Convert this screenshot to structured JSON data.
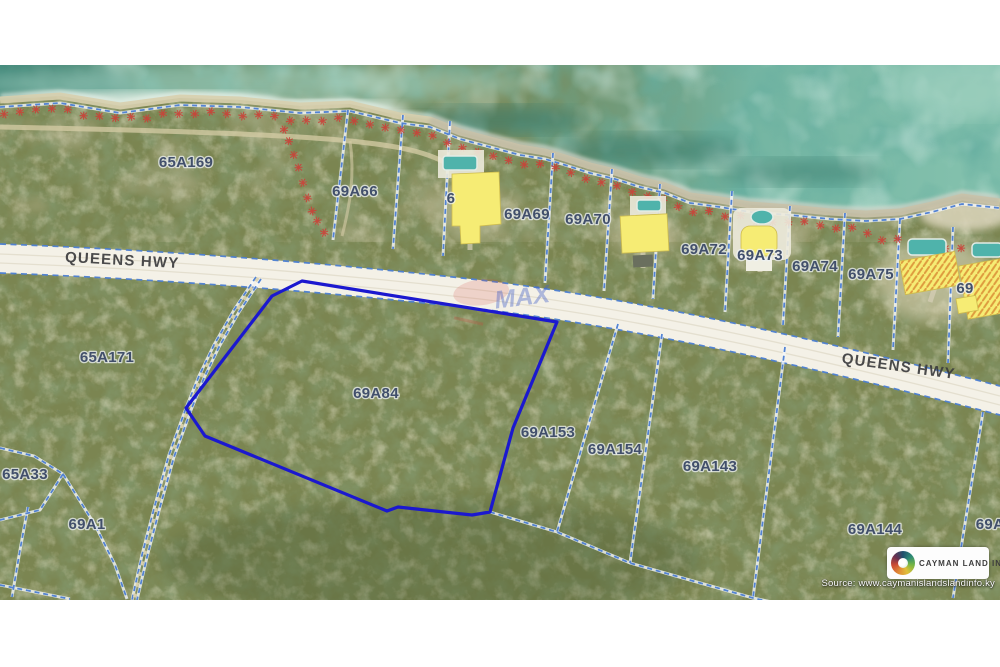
{
  "map": {
    "road_label": "QUEENS HWY",
    "watermark": "MAX",
    "highlight_color": "#1b18cf",
    "boundary_color": "#4c7ed2",
    "label_color": "#414f6b",
    "mangrove_symbol_color": "#cc4038",
    "building_color": "#f6ec74",
    "parcels": [
      {
        "label": "65A169"
      },
      {
        "label": "69A66"
      },
      {
        "label": "6"
      },
      {
        "label": "69A69"
      },
      {
        "label": "69A70"
      },
      {
        "label": "69A72"
      },
      {
        "label": "69A73"
      },
      {
        "label": "69A74"
      },
      {
        "label": "69A75"
      },
      {
        "label": "69"
      },
      {
        "label": "65A171"
      },
      {
        "label": "69A84"
      },
      {
        "label": "69A153"
      },
      {
        "label": "69A154"
      },
      {
        "label": "69A143"
      },
      {
        "label": "69A144"
      },
      {
        "label": "69A"
      },
      {
        "label": "65A33"
      },
      {
        "label": "69A1"
      }
    ]
  },
  "branding": {
    "logo_text": "CAYMAN LAND INFO",
    "source_text": "Source: www.caymanislandslandinfo.ky"
  }
}
